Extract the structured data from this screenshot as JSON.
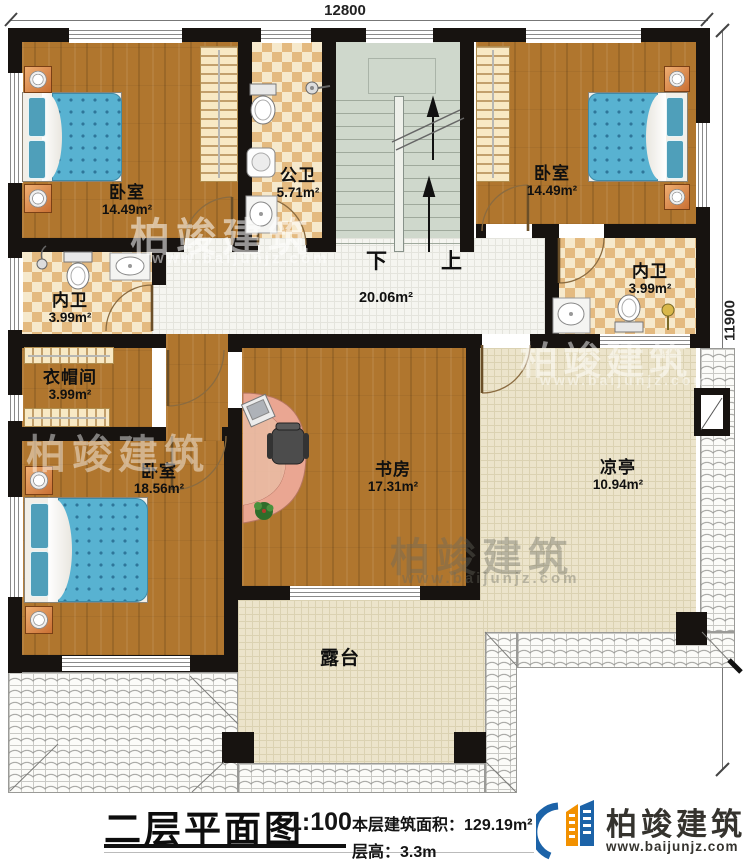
{
  "dimensions": {
    "top": "12800",
    "right": "11900"
  },
  "stair": {
    "down_label": "下",
    "up_label": "上"
  },
  "rooms": {
    "bedroom_tl": {
      "name": "卧室",
      "area": "14.49m²"
    },
    "public_bath": {
      "name": "公卫",
      "area": "5.71m²"
    },
    "bedroom_tr": {
      "name": "卧室",
      "area": "14.49m²"
    },
    "inner_bath_left": {
      "name": "内卫",
      "area": "3.99m²"
    },
    "inner_bath_right": {
      "name": "内卫",
      "area": "3.99m²"
    },
    "cloakroom": {
      "name": "衣帽间",
      "area": "3.99m²"
    },
    "hallway": {
      "area": "20.06m²"
    },
    "study": {
      "name": "书房",
      "area": "17.31m²"
    },
    "bedroom_bl": {
      "name": "卧室",
      "area": "18.56m²"
    },
    "pavilion": {
      "name": "凉亭",
      "area": "10.94m²"
    },
    "terrace": {
      "name": "露台"
    }
  },
  "titleblock": {
    "plan_title": "二层平面图",
    "scale": "1:100",
    "area_label": "本层建筑面积：",
    "area_value": "129.19m²",
    "floor_height_label": "层高：",
    "floor_height_value": "3.3m"
  },
  "brand": {
    "name": "柏竣建筑",
    "website": "www.baijunjz.com",
    "blue": "#1c63a8",
    "orange": "#f29100"
  },
  "watermark": {
    "text": "柏竣建筑",
    "website": "www.baijunjz.com"
  }
}
